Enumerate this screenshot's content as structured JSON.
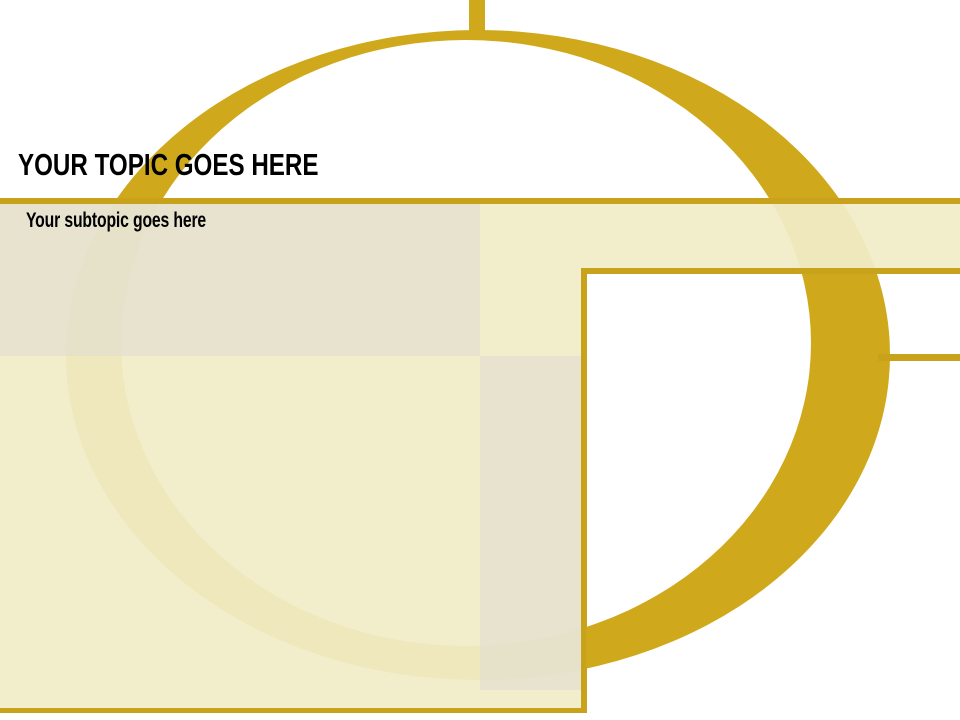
{
  "slide": {
    "title": "YOUR TOPIC GOES HERE",
    "subtitle": "Your subtopic goes here"
  },
  "colors": {
    "gold": "#CFA91B",
    "gold_line": "#C7A21A",
    "cream": "#F0EBC5",
    "beige_gray": "#E7E3CD",
    "white": "#FFFFFF",
    "text": "#000000"
  }
}
